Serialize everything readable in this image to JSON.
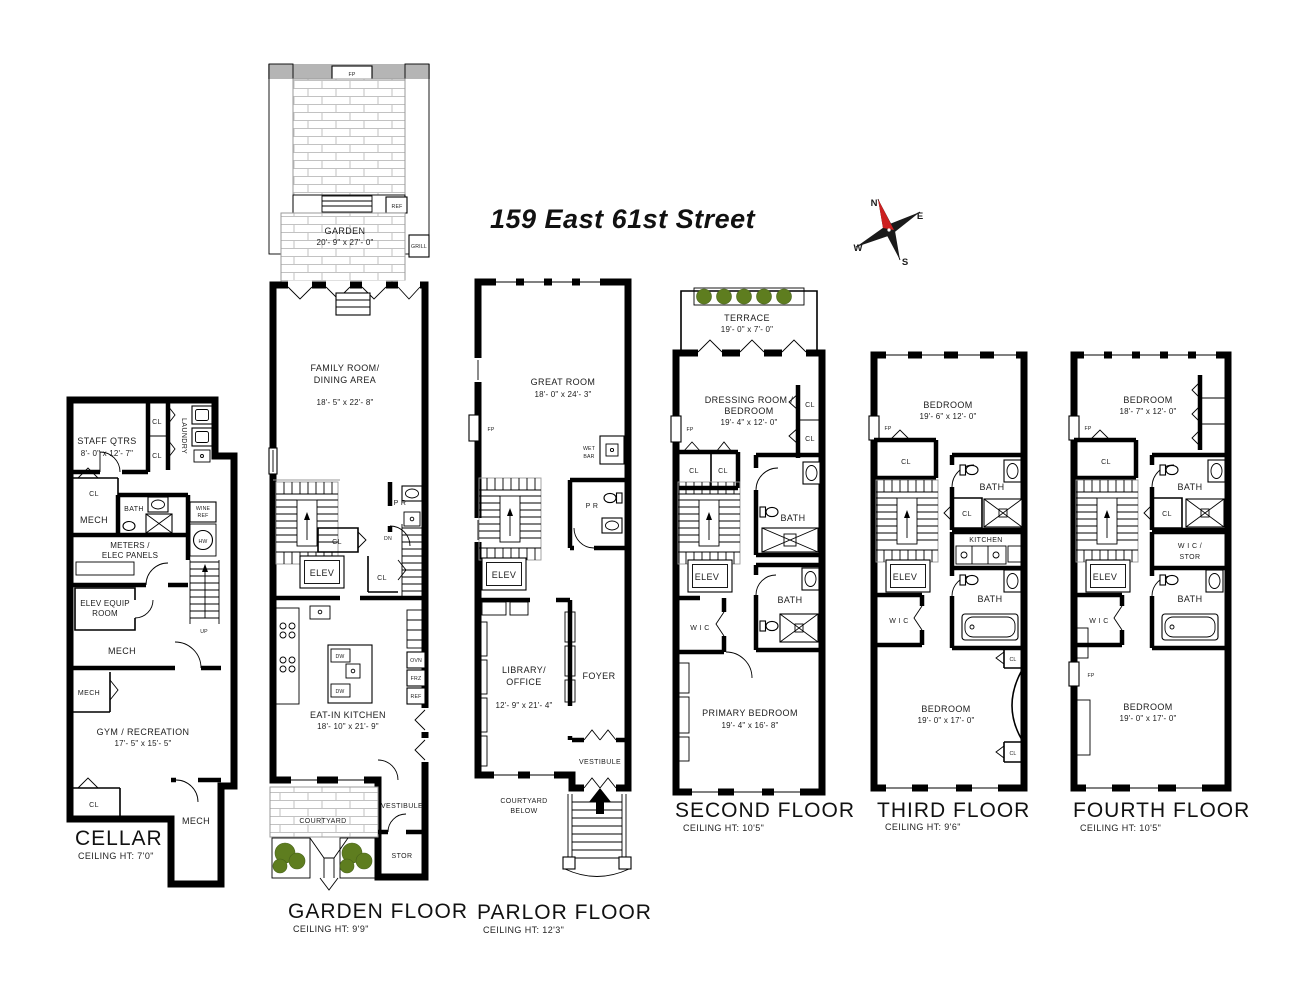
{
  "title": "159 East 61st Street",
  "compass": {
    "n": "N",
    "e": "E",
    "s": "S",
    "w": "W"
  },
  "colors": {
    "wall": "#000000",
    "shrub_green": "#7c9a33",
    "bush_green": "#5e7d1f",
    "planter_bed": "#d9c893",
    "terrace_wall_grey": "#b5b5b5",
    "brick_line": "#c2c2c2",
    "north_red": "#cc2020"
  },
  "floors": {
    "cellar": {
      "title": "CELLAR",
      "ceiling": "CEILING HT: 7'0\"",
      "rooms": {
        "staff": "STAFF QTRS",
        "staff_dim": "8'- 0\" x 12'- 7\"",
        "cl1": "CL",
        "cl2": "CL",
        "laundry": "LAUNDRY",
        "cl3": "CL",
        "mech1": "MECH",
        "bath": "BATH",
        "meters1": "METERS /",
        "meters2": "ELEC PANELS",
        "wine1": "WINE",
        "wine2": "REF",
        "hw": "HW",
        "up": "UP",
        "elev1": "ELEV EQUIP",
        "elev2": "ROOM",
        "mech2": "MECH",
        "mech3": "MECH",
        "gym": "GYM / RECREATION",
        "gym_dim": "17'- 5\" x 15'- 5\"",
        "cl4": "CL",
        "mech4": "MECH"
      }
    },
    "garden": {
      "title": "GARDEN FLOOR",
      "ceiling": "CEILING HT: 9'9\"",
      "rooms": {
        "fp": "FP",
        "garden": "GARDEN",
        "garden_dim": "20'- 9\" x 27'- 0\"",
        "ref": "REF",
        "grill": "GRILL",
        "family1": "FAMILY ROOM/",
        "family2": "DINING AREA",
        "family_dim": "18'- 5\" x 22'- 8\"",
        "pr": "P R",
        "cl1": "CL",
        "elev": "ELEV",
        "cl2": "CL",
        "dn": "DN",
        "kitchen": "EAT-IN KITCHEN",
        "kitchen_dim": "18'- 10\" x 21'- 9\"",
        "dw1": "DW",
        "dw2": "DW",
        "ovn": "OVN",
        "frz": "FRZ",
        "ref2": "REF",
        "courtyard": "COURTYARD",
        "vestibule": "VESTIBULE",
        "stor": "STOR"
      }
    },
    "parlor": {
      "title": "PARLOR FLOOR",
      "ceiling": "CEILING HT: 12'3\"",
      "rooms": {
        "great": "GREAT ROOM",
        "great_dim": "18'- 0\" x 24'- 3\"",
        "fp": "FP",
        "wet1": "WET",
        "wet2": "BAR",
        "pr": "P R",
        "elev": "ELEV",
        "library1": "LIBRARY/",
        "library2": "OFFICE",
        "library_dim": "12'- 9\" x 21'- 4\"",
        "foyer": "FOYER",
        "vestibule": "VESTIBULE",
        "courtyard1": "COURTYARD",
        "courtyard2": "BELOW"
      }
    },
    "second": {
      "title": "SECOND FLOOR",
      "ceiling": "CEILING HT: 10'5\"",
      "rooms": {
        "terrace": "TERRACE",
        "terrace_dim": "19'- 0\" x 7'- 0\"",
        "dressing1": "DRESSING ROOM /",
        "dressing2": "BEDROOM",
        "dressing_dim": "19'- 4\" x 12'- 0\"",
        "fp": "FP",
        "cl1": "CL",
        "cl2": "CL",
        "cl3": "CL",
        "cl4": "CL",
        "bath1": "BATH",
        "elev": "ELEV",
        "wic": "W I C",
        "bath2": "BATH",
        "primary": "PRIMARY BEDROOM",
        "primary_dim": "19'- 4\" x 16'- 8\""
      }
    },
    "third": {
      "title": "THIRD FLOOR",
      "ceiling": "CEILING HT: 9'6\"",
      "rooms": {
        "bedroom1": "BEDROOM",
        "bedroom1_dim": "19'- 6\" x 12'- 0\"",
        "fp": "FP",
        "cl1": "CL",
        "bath1": "BATH",
        "cl2": "CL",
        "kitchen": "KITCHEN",
        "elev": "ELEV",
        "wic": "W I C",
        "bath2": "BATH",
        "cl3": "CL",
        "cl4": "CL",
        "bedroom2": "BEDROOM",
        "bedroom2_dim": "19'- 0\" x 17'- 0\""
      }
    },
    "fourth": {
      "title": "FOURTH FLOOR",
      "ceiling": "CEILING HT: 10'5\"",
      "rooms": {
        "bedroom1": "BEDROOM",
        "bedroom1_dim": "18'- 7\" x 12'- 0\"",
        "fp1": "FP",
        "cl1": "CL",
        "bath1": "BATH",
        "cl2": "CL",
        "wic_stor1": "W I C /",
        "wic_stor2": "STOR",
        "elev": "ELEV",
        "wic": "W I C",
        "bath2": "BATH",
        "fp2": "FP",
        "bedroom2": "BEDROOM",
        "bedroom2_dim": "19'- 0\" x 17'- 0\""
      }
    }
  }
}
